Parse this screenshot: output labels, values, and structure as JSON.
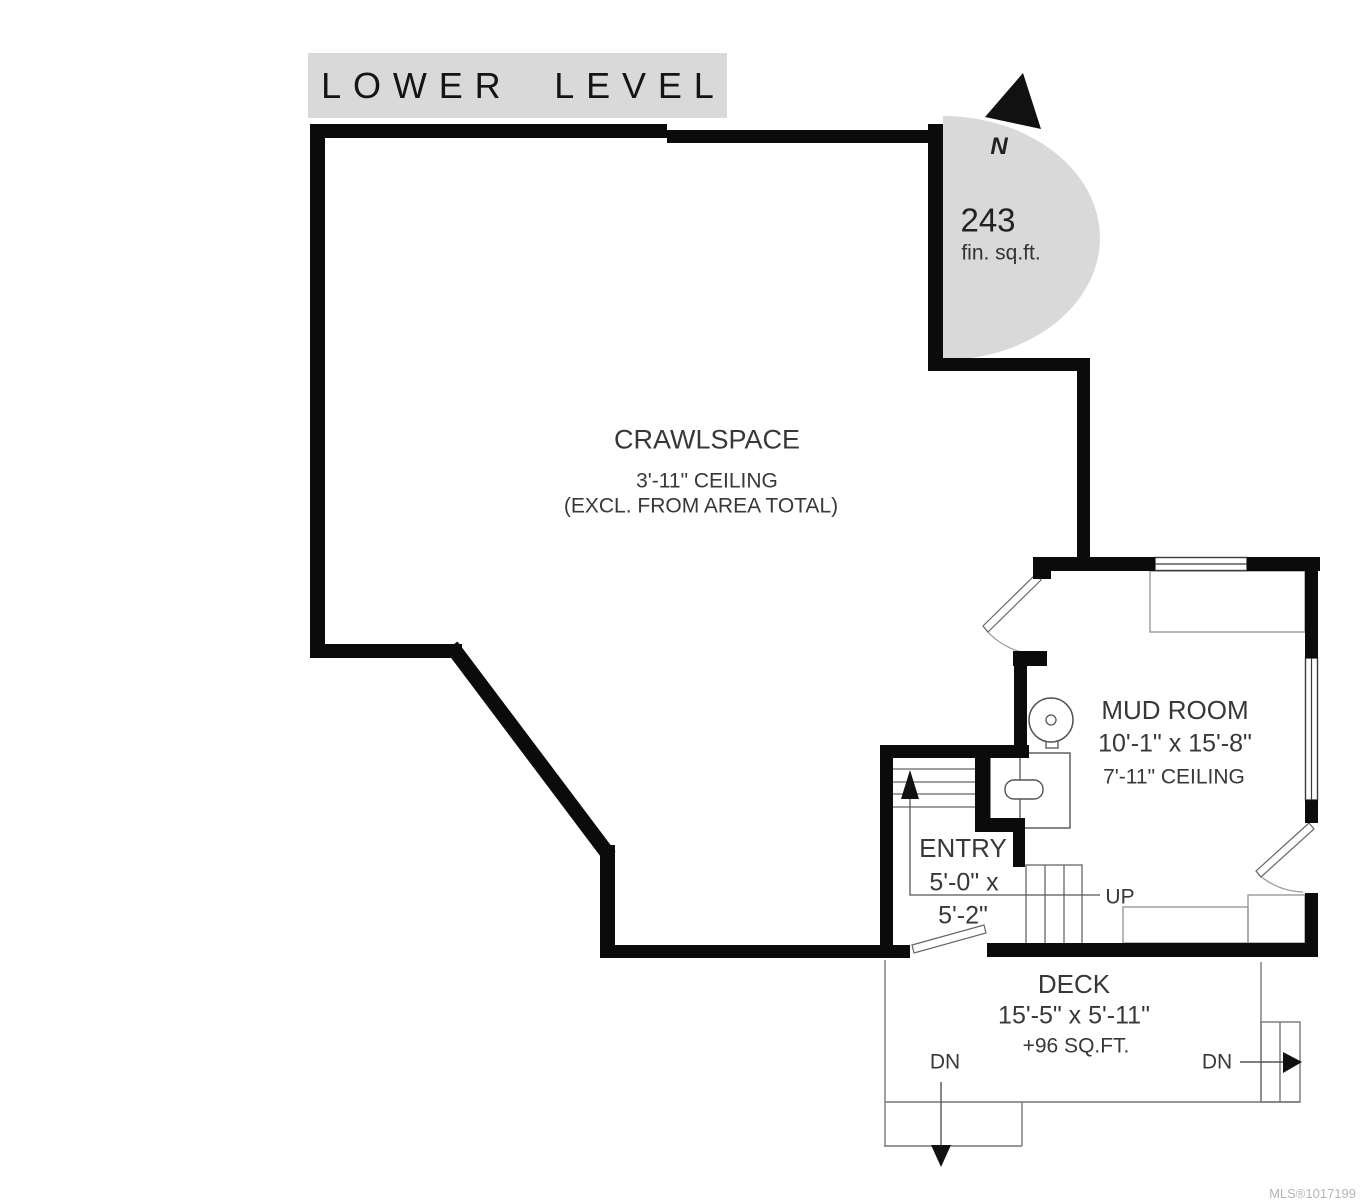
{
  "title_banner": {
    "text": "LOWER LEVEL",
    "bg": "#d9d9d9"
  },
  "compass": {
    "north_label": "N"
  },
  "area_badge": {
    "value": "243",
    "unit": "fin. sq.ft.",
    "bg": "#d9d9d9"
  },
  "rooms": {
    "crawlspace": {
      "name": "CRAWLSPACE",
      "ceiling": "3'-11\" CEILING",
      "note": "(EXCL. FROM AREA TOTAL)"
    },
    "mud_room": {
      "name": "MUD ROOM",
      "dimensions": "10'-1\" x 15'-8\"",
      "ceiling": "7'-11\" CEILING"
    },
    "entry": {
      "name": "ENTRY",
      "dimensions_line1": "5'-0\" x",
      "dimensions_line2": "5'-2\""
    },
    "deck": {
      "name": "DECK",
      "dimensions": "15'-5\" x 5'-11\"",
      "area": "+96 SQ.FT."
    }
  },
  "stair_labels": {
    "up": "UP",
    "down_left": "DN",
    "down_right": "DN"
  },
  "watermark": "MLS®1017199",
  "colors": {
    "wall": "#0b0b0b",
    "accent_gray": "#d9d9d9",
    "thin_line": "#666666",
    "text": "#383838",
    "watermark": "#b5b5b5"
  }
}
